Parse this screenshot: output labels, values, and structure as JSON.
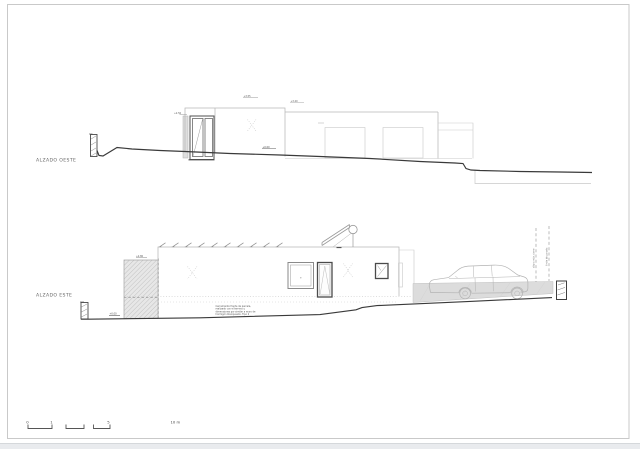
{
  "colors": {
    "line_dark": "#3a3a3a",
    "line_light": "#b8b8b8",
    "hatch_fill": "#e7e7e7",
    "paving_fill": "#dcdcdc",
    "frame_border": "#c9c9c9",
    "page_edge": "#e9ebee"
  },
  "west_elevation": {
    "label": "ALZADO OESTE",
    "levels": {
      "roof": "+3.55",
      "roof_low": "+3.20",
      "door_head": "+2.50",
      "ground": "+0.00"
    }
  },
  "east_elevation": {
    "label": "ALZADO ESTE",
    "levels": {
      "wall_top": "+2.80",
      "ground": "+0.00"
    },
    "note_lines": [
      "Cerramiento frente de parcela,",
      "realizado con el terreno y",
      "dimensiones por similar a muro de",
      "hormigón blanqueado. Tipo 2"
    ],
    "boundary_labels": [
      "altura máx. cierre",
      "límite de parcela"
    ]
  },
  "scale_bar": {
    "tick_0": "0",
    "tick_1": "1",
    "tick_5": "5",
    "tick_10": "10 m"
  }
}
